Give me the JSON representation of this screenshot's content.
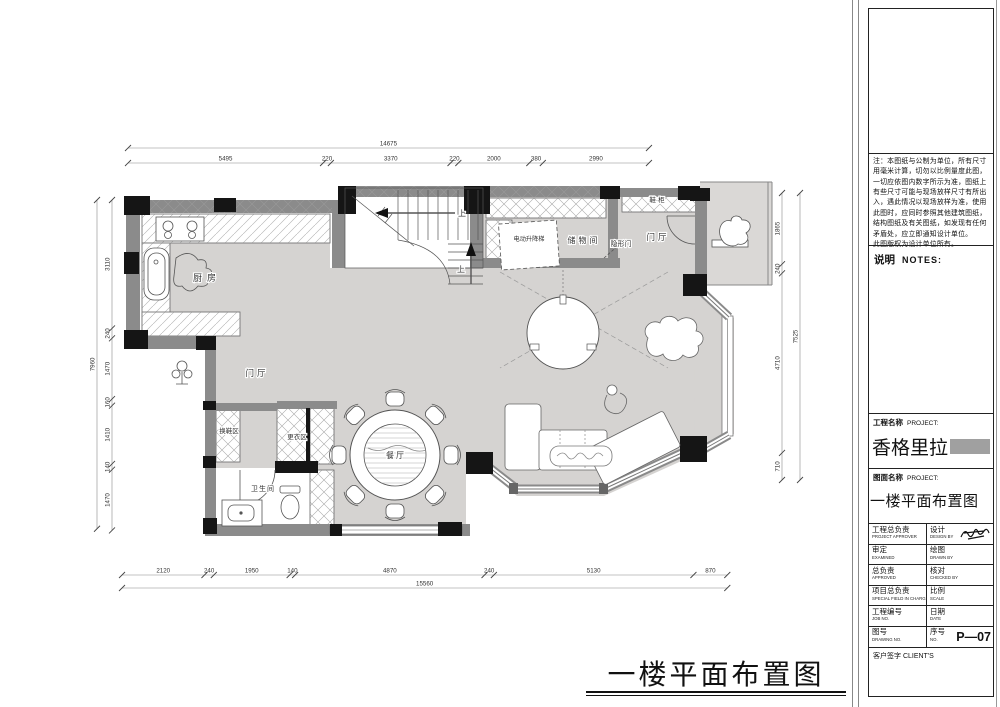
{
  "sheet": {
    "bottom_title": "一楼平面布置图",
    "notes_header_cn": "说明",
    "notes_header_en": "NOTES:",
    "notes_text": "注：本图纸与公制为单位，所有尺寸用毫米计算，切勿以比例量度此图，一切应依图内数字所示为准，图纸上有些尺寸可能与现场放样尺寸有所出入，遇此情况以现场放样为准，使用此图时，应同时参照其他建筑图纸，结构图纸及有关图纸，如发现有任何矛盾处，应立即通知设计单位。\n此图版权为设计单位所有。",
    "paper_color": "#ffffff"
  },
  "title_block": {
    "project_label_cn": "工程名称",
    "project_label_en": "PROJECT:",
    "project_name": "香格里拉",
    "drawing_label_cn": "图面名称",
    "drawing_label_en": "PROJECT:",
    "drawing_name": "一楼平面布置图",
    "rows": [
      {
        "left_cn": "工程总负责",
        "left_en": "PROJECT APPROVER",
        "right_cn": "设计",
        "right_en": "DESIGN BY",
        "right_value": ""
      },
      {
        "left_cn": "审定",
        "left_en": "EXAMINED",
        "right_cn": "绘图",
        "right_en": "DRAWN BY",
        "right_value": ""
      },
      {
        "left_cn": "总负责",
        "left_en": "APPROVED",
        "right_cn": "核对",
        "right_en": "CHECKED BY",
        "right_value": ""
      },
      {
        "left_cn": "项目总负责",
        "left_en": "SPECIAL FIELD IN CHARGE",
        "right_cn": "比例",
        "right_en": "SCALE",
        "right_value": ""
      },
      {
        "left_cn": "工程编号",
        "left_en": "JOB NO.",
        "right_cn": "日期",
        "right_en": "DATE",
        "right_value": ""
      },
      {
        "left_cn": "图号",
        "left_en": "DRAWING NO.",
        "right_cn": "序号",
        "right_en": "NO.",
        "right_value": "P—07"
      }
    ],
    "client_sign": "客户签字 CLIENT'S",
    "signature_icon": "signature-scribble",
    "redaction_color": "#a0a0a0"
  },
  "dimensions": {
    "top": {
      "total": 14675,
      "segments": [
        5495,
        220,
        3370,
        220,
        2000,
        380,
        2990
      ]
    },
    "bottom": {
      "total": 15560,
      "segments": [
        2120,
        240,
        1950,
        140,
        4870,
        240,
        5130,
        870
      ]
    },
    "left": {
      "total": 7960,
      "segments": [
        3110,
        240,
        1470,
        160,
        1410,
        140,
        1470
      ]
    },
    "right": {
      "total": 7525,
      "segments": [
        1865,
        240,
        4710,
        710
      ]
    }
  },
  "plan": {
    "rooms": [
      "厨房",
      "门厅",
      "换鞋区",
      "更衣区",
      "卫生间",
      "餐厅",
      "储物间",
      "隐形门",
      "电动升降梯",
      "鞋·柜",
      "门厅"
    ],
    "stair_up_label": "上",
    "floor_color": "#d5d3d1",
    "porch_color": "#dad8d6",
    "wall_color": "#8b8b8b",
    "column_color": "#151515"
  }
}
